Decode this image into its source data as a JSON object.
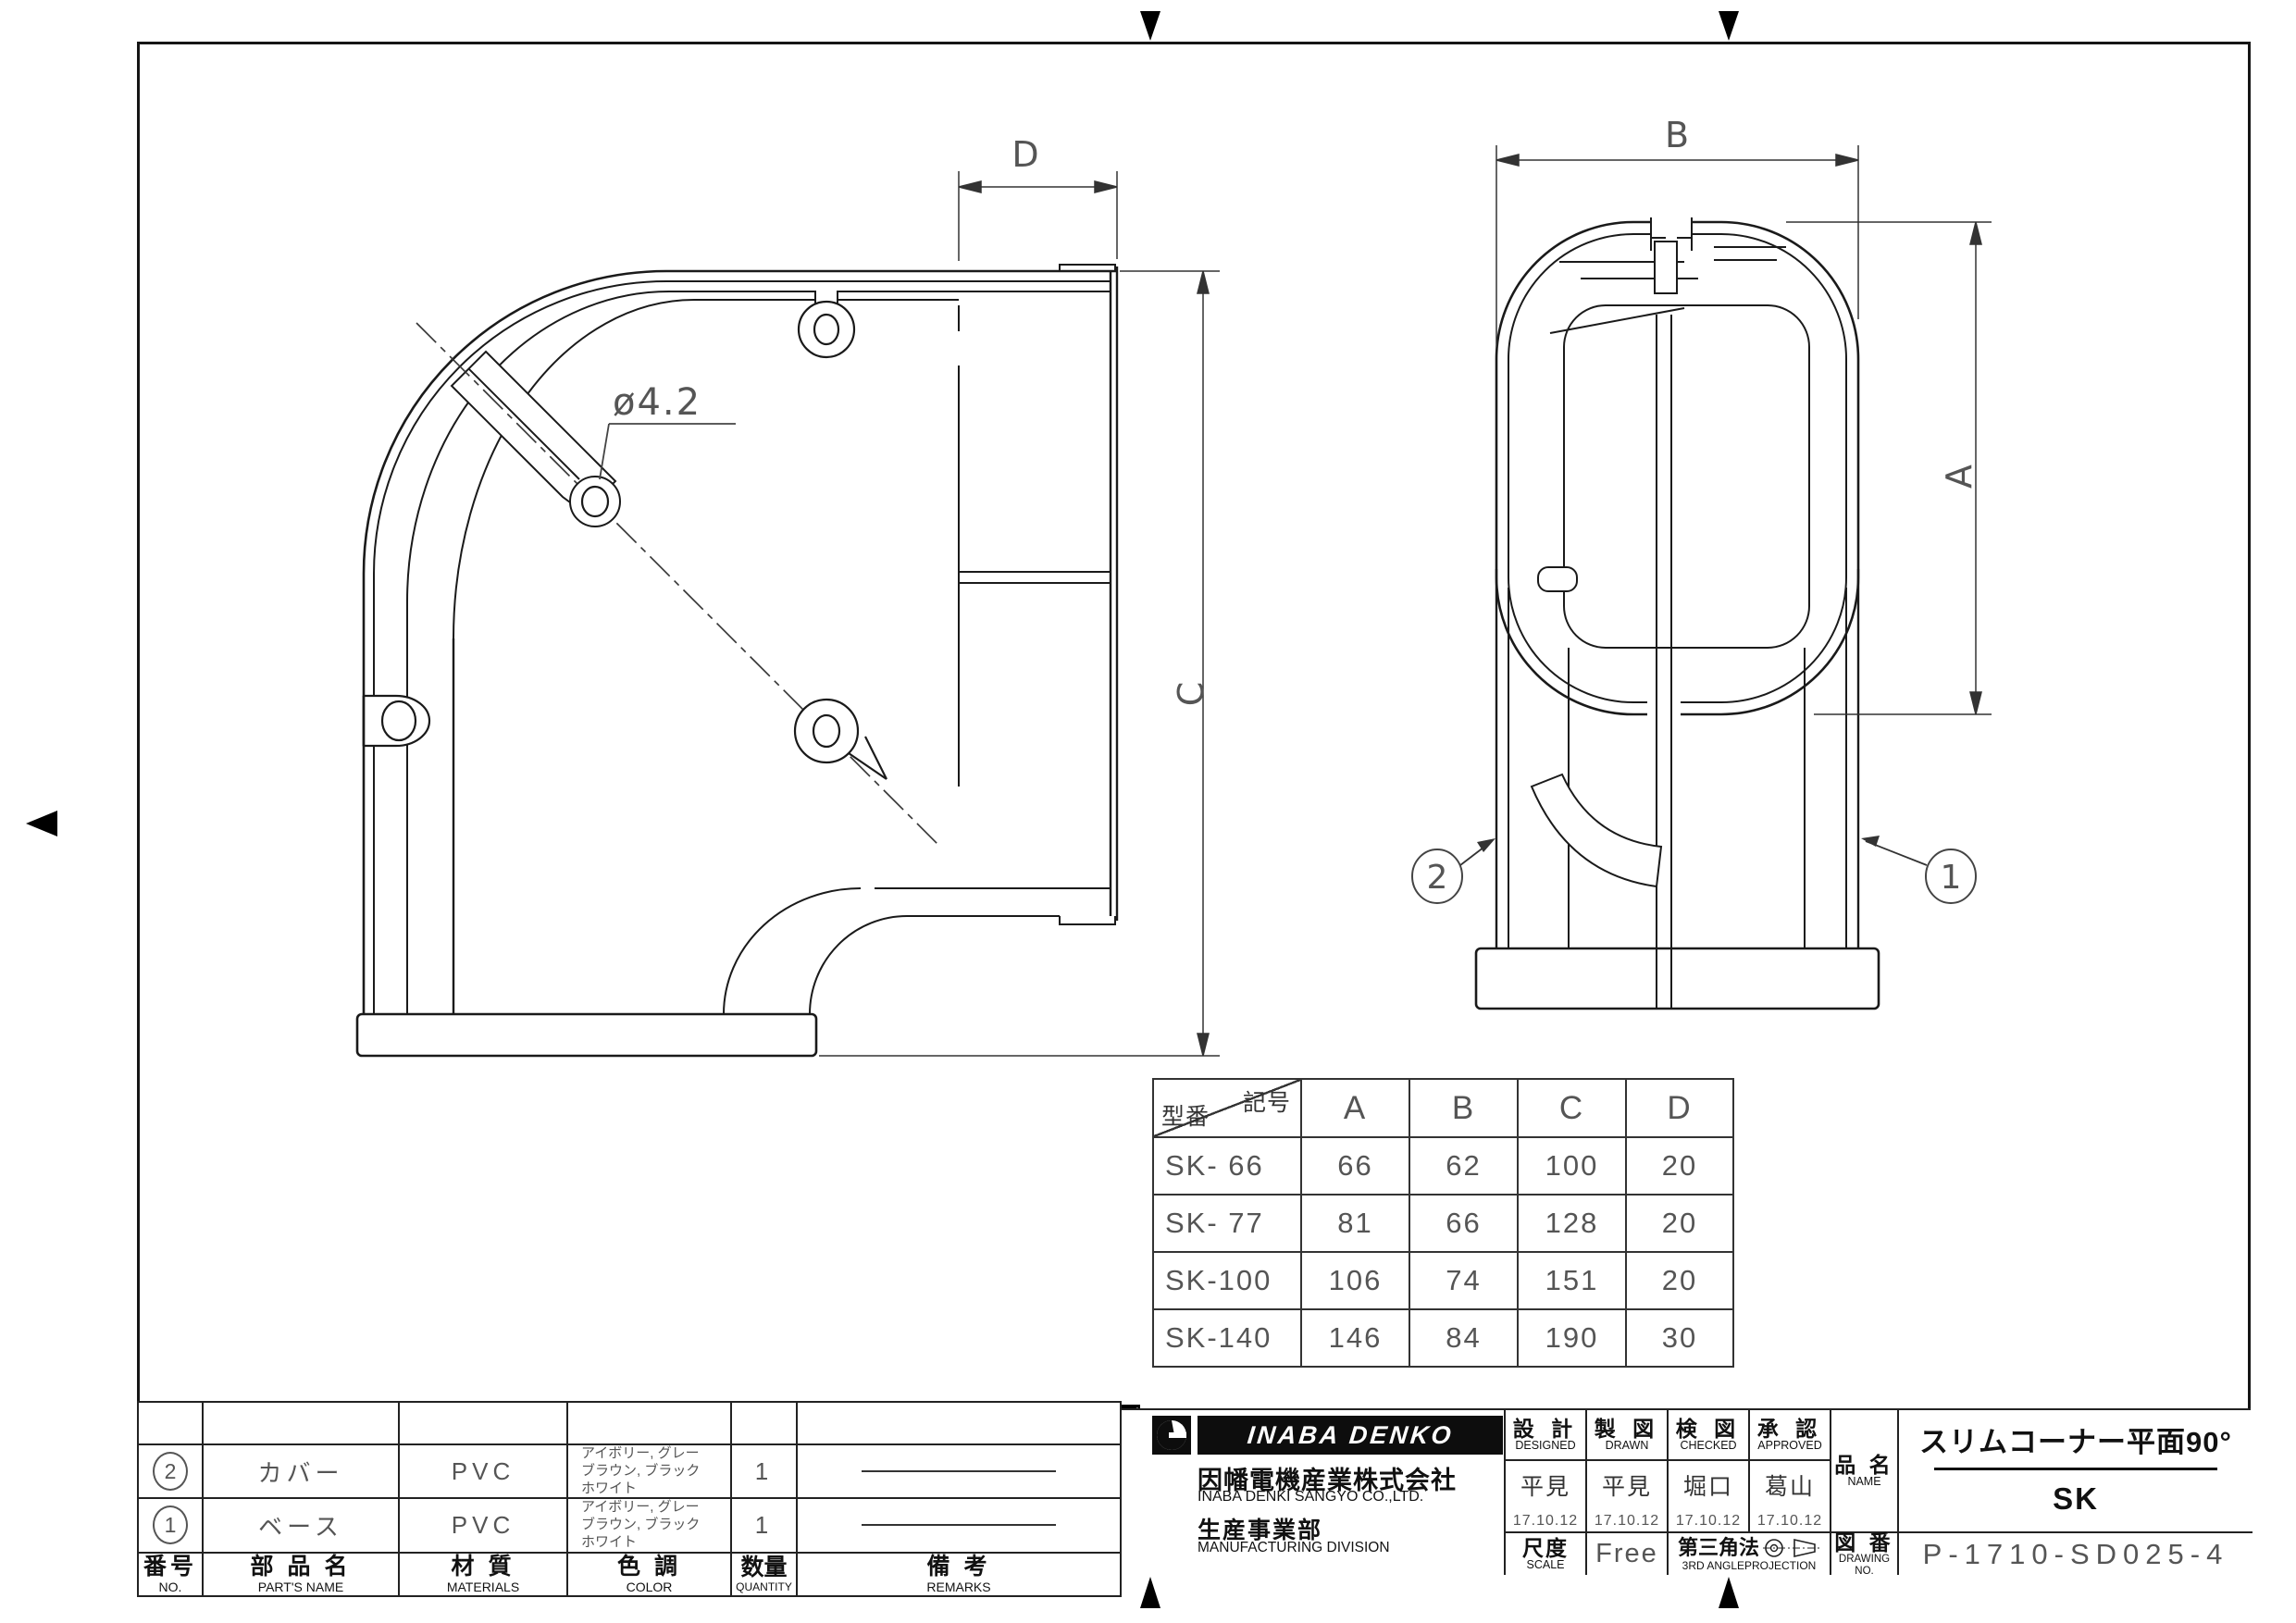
{
  "sheet": {
    "views": {
      "plan": {
        "dim_d": "D",
        "dim_c": "C",
        "hole_label": "ø4.2"
      },
      "section": {
        "dim_b": "B",
        "dim_a": "A",
        "balloon_cover": "2",
        "balloon_base": "1"
      }
    },
    "dim_table": {
      "corner_top": "記号",
      "corner_bottom": "型番",
      "columns": [
        "A",
        "B",
        "C",
        "D"
      ],
      "rows": [
        {
          "model": "SK- 66",
          "a": "66",
          "b": "62",
          "c": "100",
          "d": "20"
        },
        {
          "model": "SK- 77",
          "a": "81",
          "b": "66",
          "c": "128",
          "d": "20"
        },
        {
          "model": "SK-100",
          "a": "106",
          "b": "74",
          "c": "151",
          "d": "20"
        },
        {
          "model": "SK-140",
          "a": "146",
          "b": "84",
          "c": "190",
          "d": "30"
        }
      ]
    },
    "parts_table": {
      "headers": {
        "no_jp": "番号",
        "no_en": "NO.",
        "name_jp": "部 品 名",
        "name_en": "PART'S NAME",
        "mat_jp": "材 質",
        "mat_en": "MATERIALS",
        "color_jp": "色 調",
        "color_en": "COLOR",
        "qty_jp": "数量",
        "qty_en": "QUANTITY",
        "rem_jp": "備  考",
        "rem_en": "REMARKS"
      },
      "rows": [
        {
          "no": "2",
          "name": "カバー",
          "material": "PVC",
          "color": "アイボリー, グレー\nブラウン, ブラック\nホワイト",
          "qty": "1"
        },
        {
          "no": "1",
          "name": "ベース",
          "material": "PVC",
          "color": "アイボリー, グレー\nブラウン, ブラック\nホワイト",
          "qty": "1"
        }
      ]
    },
    "title_block": {
      "logo_text": "INABA DENKO",
      "company_jp": "因幡電機産業株式会社",
      "company_en": "INABA DENKI SANGYO CO.,LTD.",
      "division_jp": "生産事業部",
      "division_en": "MANUFACTURING DIVISION",
      "approvals": [
        {
          "jp": "設 計",
          "en": "DESIGNED",
          "name": "平見",
          "date": "17.10.12"
        },
        {
          "jp": "製 図",
          "en": "DRAWN",
          "name": "平見",
          "date": "17.10.12"
        },
        {
          "jp": "検 図",
          "en": "CHECKED",
          "name": "堀口",
          "date": "17.10.12"
        },
        {
          "jp": "承 認",
          "en": "APPROVED",
          "name": "葛山",
          "date": "17.10.12"
        }
      ],
      "scale_jp": "尺度",
      "scale_en": "SCALE",
      "scale_value": "Free",
      "projection_jp": "第三角法",
      "projection_en": "3RD ANGLEPROJECTION",
      "name_label_jp": "品 名",
      "name_label_en": "NAME",
      "product_name": "スリムコーナー平面90°",
      "product_code": "SK",
      "dwgno_label_jp": "図 番",
      "dwgno_label_en": "DRAWING NO.",
      "drawing_no": "P-1710-SD025-4"
    }
  }
}
